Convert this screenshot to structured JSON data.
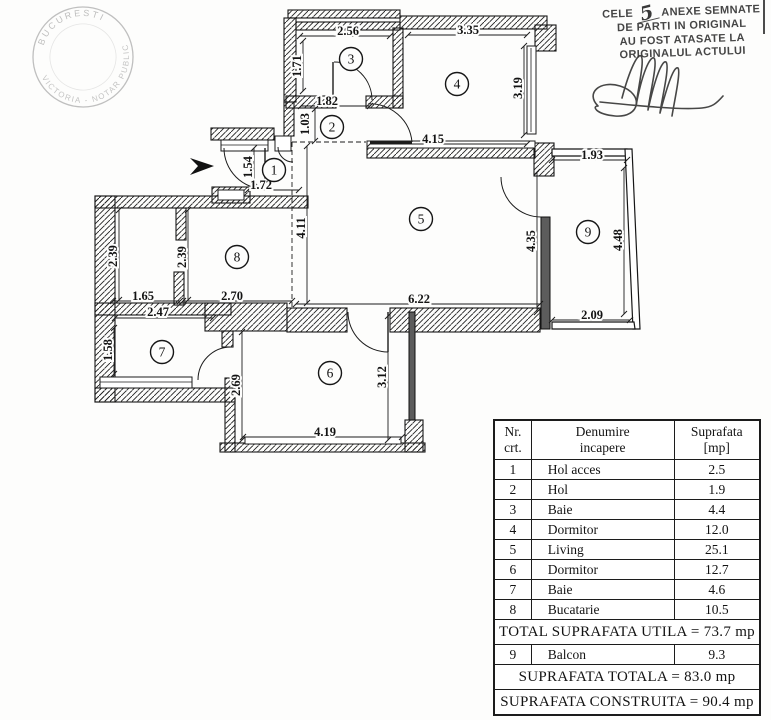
{
  "notary_stamp": {
    "top_text": "BUCURESTI",
    "bottom_text": "VICTORIA - NOTAR PUBLIC"
  },
  "certification": {
    "line1_prefix": "CELE",
    "line1_number": "5",
    "line1_suffix": "ANEXE SEMNATE",
    "line2": "DE PARTI IN ORIGINAL",
    "line3": "AU FOST ATASATE LA",
    "line4": "ORIGINALUL ACTULUI"
  },
  "table": {
    "headers": [
      "Nr.\ncrt.",
      "Denumire\nincapere",
      "Suprafata\n[mp]"
    ],
    "rows": [
      [
        "1",
        "Hol acces",
        "2.5"
      ],
      [
        "2",
        "Hol",
        "1.9"
      ],
      [
        "3",
        "Baie",
        "4.4"
      ],
      [
        "4",
        "Dormitor",
        "12.0"
      ],
      [
        "5",
        "Living",
        "25.1"
      ],
      [
        "6",
        "Dormitor",
        "12.7"
      ],
      [
        "7",
        "Baie",
        "4.6"
      ],
      [
        "8",
        "Bucatarie",
        "10.5"
      ]
    ],
    "total_utila": "TOTAL SUPRAFATA UTILA = 73.7 mp",
    "balcon_row": [
      "9",
      "Balcon",
      "9.3"
    ],
    "total_totala": "SUPRAFATA TOTALA = 83.0 mp",
    "total_construita": "SUPRAFATA CONSTRUITA = 90.4 mp"
  },
  "floor_plan": {
    "rooms": [
      {
        "n": "1",
        "x": 274,
        "y": 170
      },
      {
        "n": "2",
        "x": 332,
        "y": 127
      },
      {
        "n": "3",
        "x": 351,
        "y": 59
      },
      {
        "n": "4",
        "x": 457,
        "y": 84
      },
      {
        "n": "5",
        "x": 421,
        "y": 219
      },
      {
        "n": "6",
        "x": 330,
        "y": 373
      },
      {
        "n": "7",
        "x": 162,
        "y": 352
      },
      {
        "n": "8",
        "x": 237,
        "y": 257
      },
      {
        "n": "9",
        "x": 588,
        "y": 232
      }
    ],
    "dims": [
      {
        "t": "2.56",
        "l": [
          300,
          36,
          390,
          36
        ],
        "p": [
          348,
          35
        ],
        "r": 0
      },
      {
        "t": "3.35",
        "l": [
          408,
          35,
          527,
          35
        ],
        "p": [
          468,
          34
        ],
        "r": 0
      },
      {
        "t": "1.71",
        "l": [
          303,
          41,
          303,
          91
        ],
        "p": [
          301,
          66
        ],
        "r": 1
      },
      {
        "t": "1.82",
        "l": [
          301,
          106,
          370,
          106
        ],
        "p": [
          327,
          105
        ],
        "r": 0
      },
      {
        "t": "1.03",
        "l": [
          315,
          109,
          315,
          141
        ],
        "p": [
          309,
          124
        ],
        "r": 1
      },
      {
        "t": "3.19",
        "l": [
          524,
          46,
          524,
          135
        ],
        "p": [
          522,
          88
        ],
        "r": 1
      },
      {
        "t": "4.15",
        "l": [
          370,
          144,
          527,
          144
        ],
        "p": [
          433,
          143
        ],
        "r": 0
      },
      {
        "t": "1.54",
        "l": [
          254,
          148,
          254,
          187
        ],
        "p": [
          252,
          167
        ],
        "r": 1
      },
      {
        "t": "1.72",
        "l": [
          248,
          190,
          299,
          190
        ],
        "p": [
          261,
          189
        ],
        "r": 0
      },
      {
        "t": "4.11",
        "l": [
          307,
          146,
          307,
          303
        ],
        "p": [
          305,
          228
        ],
        "r": 1
      },
      {
        "t": "2.39",
        "l": [
          119,
          210,
          119,
          300
        ],
        "p": [
          117,
          256
        ],
        "r": 1
      },
      {
        "t": "2.39",
        "l": [
          188,
          210,
          188,
          300
        ],
        "p": [
          186,
          257
        ],
        "r": 1
      },
      {
        "t": "1.65",
        "l": [
          113,
          301,
          180,
          301
        ],
        "p": [
          143,
          300
        ],
        "r": 0
      },
      {
        "t": "2.70",
        "l": [
          183,
          301,
          292,
          301
        ],
        "p": [
          232,
          300
        ],
        "r": 0
      },
      {
        "t": "6.22",
        "l": [
          296,
          304,
          540,
          304
        ],
        "p": [
          419,
          303
        ],
        "r": 0
      },
      {
        "t": "4.35",
        "l": [
          537,
          172,
          537,
          312
        ],
        "p": [
          535,
          241
        ],
        "r": 1
      },
      {
        "t": "1.93",
        "l": [
          552,
          160,
          627,
          160
        ],
        "p": [
          592,
          159
        ],
        "r": 0
      },
      {
        "t": "4.48",
        "l": [
          624,
          168,
          624,
          314
        ],
        "p": [
          622,
          240
        ],
        "r": 1
      },
      {
        "t": "2.09",
        "l": [
          552,
          320,
          630,
          320
        ],
        "p": [
          592,
          319
        ],
        "r": 0
      },
      {
        "t": "2.47",
        "l": [
          115,
          318,
          213,
          318
        ],
        "p": [
          158,
          316
        ],
        "r": 0
      },
      {
        "t": "1.58",
        "l": [
          114,
          328,
          114,
          374
        ],
        "p": [
          112,
          350
        ],
        "r": 1
      },
      {
        "t": "2.69",
        "l": [
          242,
          332,
          242,
          440
        ],
        "p": [
          240,
          385
        ],
        "r": 1
      },
      {
        "t": "3.12",
        "l": [
          388,
          316,
          388,
          440
        ],
        "p": [
          386,
          377
        ],
        "r": 1
      },
      {
        "t": "4.19",
        "l": [
          243,
          437,
          402,
          437
        ],
        "p": [
          325,
          436
        ],
        "r": 0
      }
    ],
    "walls_hatched": [
      [
        288,
        10,
        112,
        8
      ],
      [
        296,
        22,
        104,
        8
      ],
      [
        400,
        16,
        147,
        13
      ],
      [
        535,
        25,
        21,
        26
      ],
      [
        284,
        18,
        12,
        84
      ],
      [
        393,
        28,
        10,
        80
      ],
      [
        286,
        96,
        50,
        12
      ],
      [
        366,
        96,
        37,
        12
      ],
      [
        284,
        102,
        10,
        34
      ],
      [
        211,
        128,
        63,
        12
      ],
      [
        212,
        187,
        38,
        16
      ],
      [
        95,
        196,
        213,
        12
      ],
      [
        95,
        196,
        20,
        206
      ],
      [
        176,
        208,
        10,
        32
      ],
      [
        174,
        272,
        10,
        33
      ],
      [
        95,
        303,
        136,
        12
      ],
      [
        205,
        303,
        82,
        28
      ],
      [
        222,
        331,
        11,
        16
      ],
      [
        95,
        388,
        140,
        14
      ],
      [
        225,
        378,
        10,
        74
      ],
      [
        220,
        443,
        205,
        9
      ],
      [
        405,
        420,
        18,
        32
      ],
      [
        287,
        308,
        60,
        24
      ],
      [
        390,
        308,
        150,
        24
      ],
      [
        367,
        148,
        168,
        10
      ],
      [
        534,
        143,
        20,
        33
      ]
    ],
    "walls_solid": [
      [
        541,
        217,
        9,
        112
      ],
      [
        409,
        312,
        6,
        108
      ]
    ],
    "parapets": [
      "552,149 627,149 627,156 552,156",
      "625,149 632,149 640,329 633,329",
      "552,322 634,322 635,329 552,329"
    ],
    "windows": [
      [
        221,
        140,
        47,
        11
      ],
      [
        275,
        136,
        16,
        15
      ],
      [
        218,
        190,
        26,
        10
      ],
      [
        527,
        46,
        9,
        88
      ],
      [
        367,
        141,
        168,
        7
      ],
      [
        100,
        377,
        92,
        11
      ],
      [
        245,
        437,
        156,
        7
      ]
    ],
    "window_midlines": [
      [
        221,
        145,
        268,
        145
      ],
      [
        531,
        48,
        531,
        132
      ],
      [
        100,
        382,
        192,
        382
      ]
    ],
    "door_arcs": [
      "M 224,148 A 41 41 0 0 0 265,189",
      "M 278,147 A 15 15 0 0 0 293,162",
      "M 334,62 A 38 38 0 0 1 372,100",
      "M 412,142 A 42 42 0 0 0 368,104",
      "M 231,347 A 33 33 0 0 0 198,380",
      "M 348,312 A 40 40 0 0 0 388,352",
      "M 501,177 A 40 40 0 0 0 541,217"
    ],
    "door_leaves": [
      [
        265,
        148,
        265,
        188
      ],
      [
        333,
        62,
        333,
        100
      ],
      [
        388,
        312,
        388,
        352
      ]
    ],
    "door_leaves_thick": [
      [
        370,
        142,
        412,
        142
      ]
    ],
    "dashed_lines": [
      [
        292,
        142,
        366,
        142
      ],
      [
        292,
        142,
        292,
        307
      ]
    ],
    "entrance_arrow": "190,158 214,166 190,175 198,166"
  }
}
